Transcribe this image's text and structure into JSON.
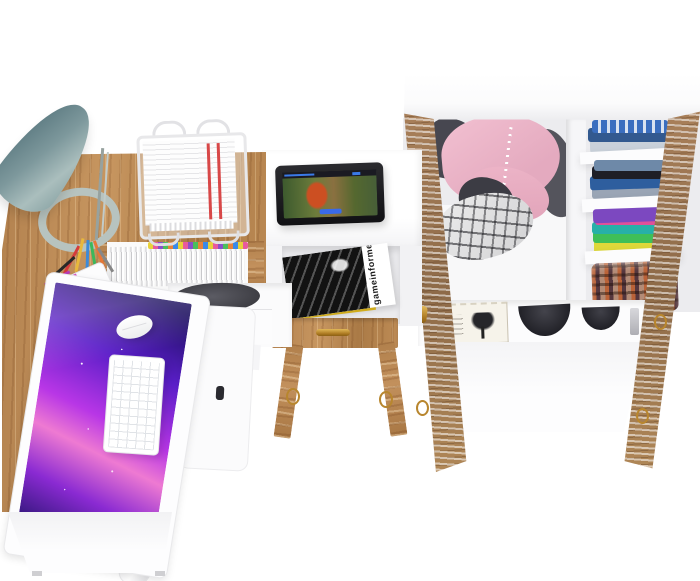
{
  "scene": {
    "description": "Bird's-eye 3D product render on white background: kids-room furniture set with an L-shaped oak desk (lamp, iMac-style monitor, keyboard, mouse, document tray, pencil cup, row of tabbed files), a white media side table with a tablet playing an animated movie and a magazine compartment, and an open white wardrobe with weathered oak doors holding hanging and folded clothes",
    "background_color": "#ffffff"
  },
  "palette": {
    "oak_wood": "#b3824f",
    "furniture_white": "#fafafa",
    "lamp_teal": "#6f8d91",
    "screen_galaxy_purple": "#b836e6",
    "shirt_pink": "#eeb3c8",
    "denim_blue": "#2f5d9e",
    "stack_purple": "#7c48c0",
    "stack_teal": "#28b0a8",
    "stack_green": "#40bf58",
    "stack_yellow": "#e0dc3c",
    "basket_rust": "#8a4838",
    "gold_hardware": "#b8862e",
    "magazine_cover_black": "#121212",
    "red_document_stripe": "#d84848"
  },
  "objects": {
    "desk": {
      "label": "L-shaped oak desk with white front panel"
    },
    "lamp": {
      "label": "teal cone desk lamp with oval base"
    },
    "monitor": {
      "label": "white monitor showing purple galaxy wallpaper"
    },
    "keyboard": {
      "label": "white compact keyboard"
    },
    "mouse": {
      "label": "white mouse"
    },
    "document_tray": {
      "label": "white wire document tray with red-striped papers"
    },
    "pencil_cup": {
      "label": "white cup with colored pens and pencils"
    },
    "files_row": {
      "label": "row of white files with colored index tabs"
    },
    "under_desk_bag": {
      "label": "dark pouch in open cubby"
    },
    "desk_drawer": {
      "label": "white drawer with metal bar handle"
    },
    "side_table": {
      "label": "white media side table with oak drawer and splayed legs"
    },
    "tablet": {
      "label": "black tablet playing animated movie with red-haired heroine"
    },
    "magazine": {
      "title": "gameinformer"
    },
    "wardrobe": {
      "label": "white wardrobe, both weathered-oak doors open"
    },
    "hanging_clothes": {
      "label": "pink button shirt, dark jacket, plaid shirt on hangers"
    },
    "folded_stack_top": {
      "label": "blue folded clothes"
    },
    "folded_stack_middle": {
      "label": "denim and black folded clothes"
    },
    "folded_stack_colorful": {
      "label": "purple, teal, green and yellow folded tees"
    },
    "storage_basket": {
      "label": "rust plaid storage basket"
    },
    "keepsake_box": {
      "label": "cream keepsake box with tree print"
    },
    "dark_bowls": {
      "label": "two dark round items on bottom shelf"
    }
  }
}
